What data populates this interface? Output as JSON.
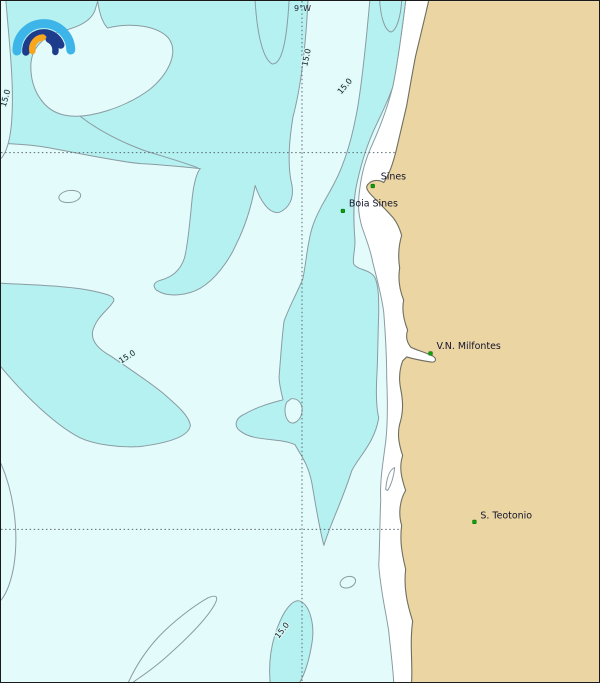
{
  "map": {
    "meridian_label": "9°W",
    "contour_labels": [
      "15.0",
      "15.0",
      "15.0",
      "15.0",
      "15.0"
    ],
    "places": [
      {
        "name": "Sines"
      },
      {
        "name": "Boia Sines"
      },
      {
        "name": "V.N. Milfontes"
      },
      {
        "name": "S. Teotonio"
      }
    ],
    "logo": {
      "name": "rainbow-arcs-logo"
    },
    "colors": {
      "sea_band": "#b5f1f1",
      "sea_pale": "#e4fbfb",
      "coast_strip": "#ffffff",
      "land": "#ead5a3",
      "contour": "#8a9ba1",
      "coastline": "#6e6e60",
      "grid": "#5a6a72",
      "marker_green": "#0ca30c",
      "marker_edge": "#076d07",
      "label_text": "#14142b",
      "logo_light_blue": "#3db5e8",
      "logo_navy": "#1d3c8c",
      "logo_orange": "#f8a61e"
    }
  }
}
